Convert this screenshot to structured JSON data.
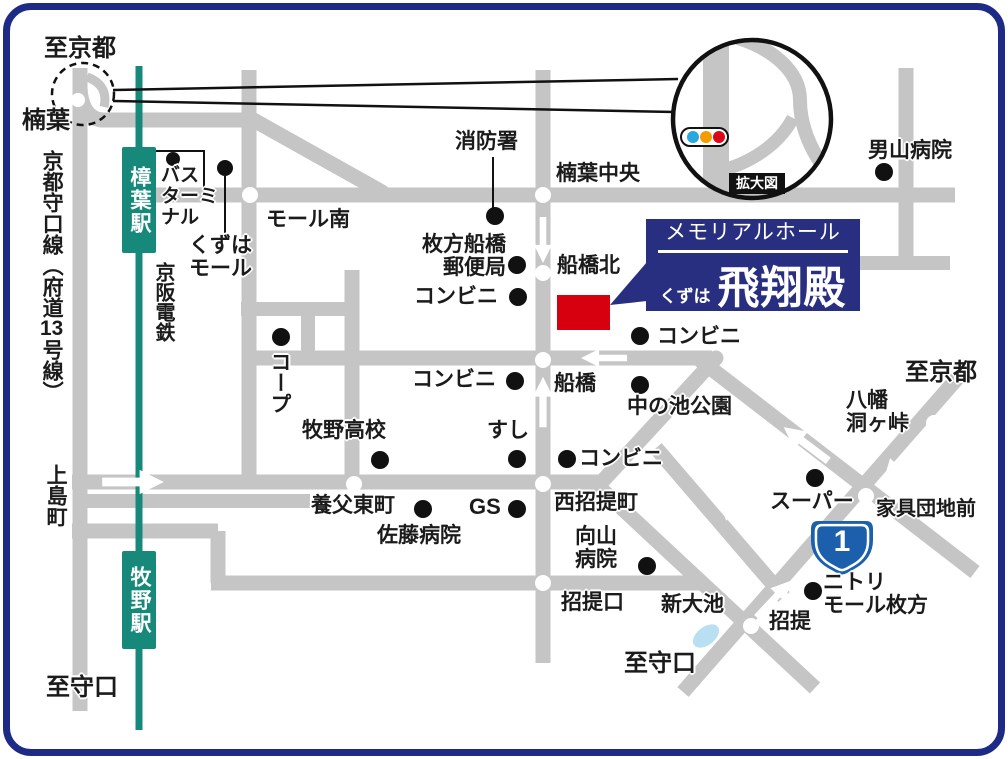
{
  "colors": {
    "road": "#c5c5c5",
    "railway": "#17897b",
    "border": "#1d2b86",
    "banner": "#282e80",
    "destination_red": "#d7000f",
    "pond_blue": "#b9e0f2",
    "badge_blue": "#1c5fad",
    "traffic1": "#29a8e0",
    "traffic2": "#f49b00",
    "traffic3": "#dc0716"
  },
  "banner": {
    "title": "メモリアルホール",
    "subtitle": "くずは",
    "name": "飛翔殿"
  },
  "inset": {
    "caption": "拡大図"
  },
  "route_badge": {
    "number": "1"
  },
  "stations": {
    "kuzuha": "樟葉駅",
    "makino": "牧野駅"
  },
  "labels": {
    "to_kyoto": "至京都",
    "to_moriguchi": "至守口",
    "kuzuha_junction": "楠葉",
    "kyoto_moriguchi_line_pre": "京都守口線（府道",
    "kyoto_moriguchi_line_num": "13",
    "kyoto_moriguchi_line_post": "号線）",
    "kamijima_cho": "上島町",
    "keihan_railway": "京阪電鉄",
    "bus_terminal": [
      "バス",
      "ターミ",
      "ナル"
    ],
    "kuzuha_mall": [
      "くずは",
      "モール"
    ],
    "mall_south": "モール南",
    "coop": "コープ",
    "fire_station": "消防署",
    "kuzuha_chuo": "楠葉中央",
    "post_office": [
      "枚方船橋",
      "郵便局"
    ],
    "convenience_store": "コンビニ",
    "funabashi_kita": "船橋北",
    "nakanoike_park": "中の池公園",
    "otokoyama_hospital": "男山病院",
    "funabashi": "船橋",
    "makino_high_school": "牧野高校",
    "sushi": "すし",
    "yabu_higashimachi": "養父東町",
    "sato_hospital": "佐藤病院",
    "gas_station": "GS",
    "nishi_shodai_cho": "西招提町",
    "mukaiyama_hospital": [
      "向山",
      "病院"
    ],
    "shodai_guchi": "招提口",
    "shin_oike": "新大池",
    "shodai": "招提",
    "nitori": [
      "ニトリ",
      "モール枚方"
    ],
    "super_market": "スーパー",
    "kagu_danchi_mae": "家具団地前",
    "yawata_horagatoge": [
      "八幡",
      "洞ヶ峠"
    ]
  }
}
